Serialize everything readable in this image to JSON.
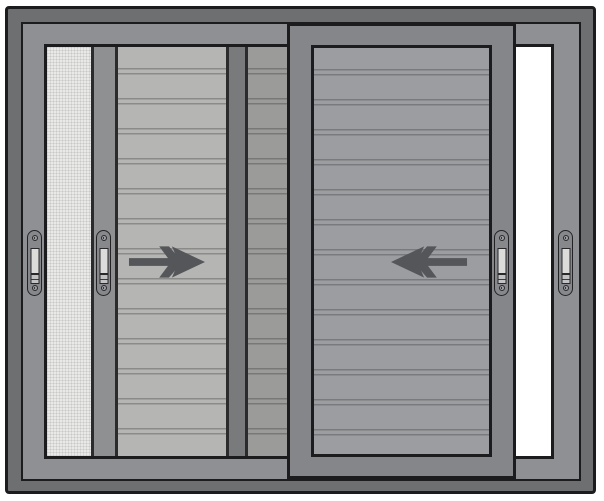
{
  "diagram": {
    "kind": "sliding-window",
    "arrows": [
      {
        "id": "slide-right-arrow",
        "direction": "right",
        "on": "left-sash-shutter-panel"
      },
      {
        "id": "slide-left-arrow",
        "direction": "left",
        "on": "right-sash-shutter-panel"
      }
    ],
    "handles": [
      "frame-left-handle",
      "left-sash-handle",
      "right-sash-handle",
      "frame-right-handle"
    ],
    "panels": [
      "frosted-glass-panel",
      "left-sash-stile",
      "left-sash-shutter-panel",
      "interlock-stile",
      "shaded-shutter-panel",
      "right-sash",
      "right-sash-shutter-panel",
      "open-gap"
    ],
    "slat_period_px": 30
  },
  "colors": {
    "outline": "#1c1c1e",
    "outer_frame": "#6e6f71",
    "inner_frame": "#8f9093",
    "glass": "#e9e9e7",
    "stile": "#8f9092",
    "dark_stile": "#797a7c",
    "shutter_panel": "#b5b5b3",
    "shutter_line": "#8a8a88",
    "sash_frame": "#85868a",
    "sash_panel": "#9c9da0",
    "sash_line": "#797a7d",
    "handle_body": "#87888c",
    "handle_plate": "#dcdcda",
    "arrow": "#55565a",
    "gap": "#ffffff",
    "line": "#2b2b2d"
  }
}
